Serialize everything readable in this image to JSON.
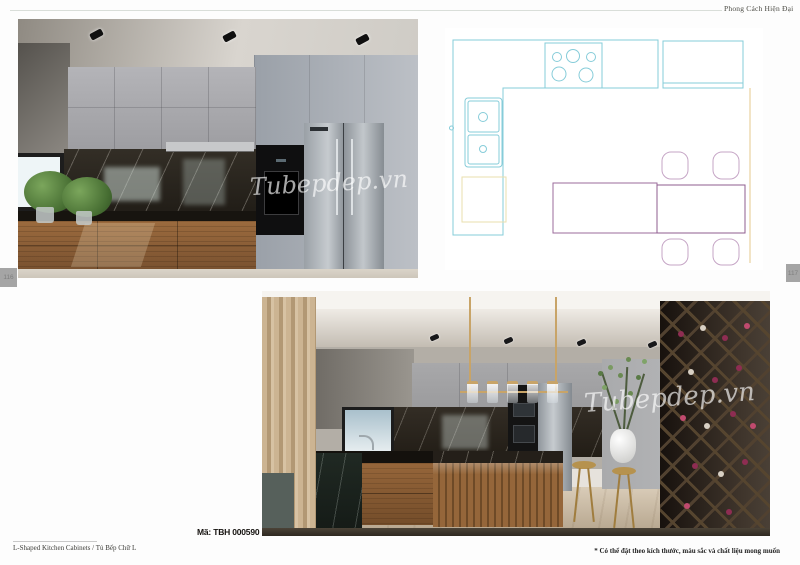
{
  "header": {
    "title": "Phong Cách Hiện Đại"
  },
  "page_tabs": {
    "left": "116",
    "right": "117"
  },
  "product": {
    "code_label": "Mã: TBH 000590"
  },
  "renders": {
    "top": {
      "watermark": "Tubepdep.vn",
      "description": "L-shaped kitchen render: gray upper cabinets, dark marble backsplash, wood drawer base cabinets, window with plants, black oven tower, stainless side-by-side fridge, recessed ceiling spotlights"
    },
    "bottom": {
      "watermark": "Tubepdep.vn",
      "description": "Kitchen render: wood island with marble top, gold linear pendant light, beige curtain, window, white vase with branches, brass stools, diamond wine rack wall"
    }
  },
  "floor_plan": {
    "description": "CAD top view of L-shaped kitchen layout",
    "elements": [
      "L-shaped counter run",
      "5-burner cooktop",
      "double sink",
      "refrigerator box",
      "wall cabinet run",
      "kitchen island",
      "dining table",
      "4 chairs"
    ],
    "colors": {
      "counter_lines": "#86ccd9",
      "island_line": "#9b6b9b",
      "table_line": "#8f5c8f",
      "chair_lines": "#c6a6c6",
      "fridge_box_line": "#eadfae",
      "right_wall_line": "#e6c98c"
    }
  },
  "footer": {
    "left_text": "L-Shaped Kitchen Cabinets / Tủ Bếp Chữ L",
    "right_note": "* Có thể đặt theo kích thước, màu sắc và chất liệu mong muốn"
  }
}
